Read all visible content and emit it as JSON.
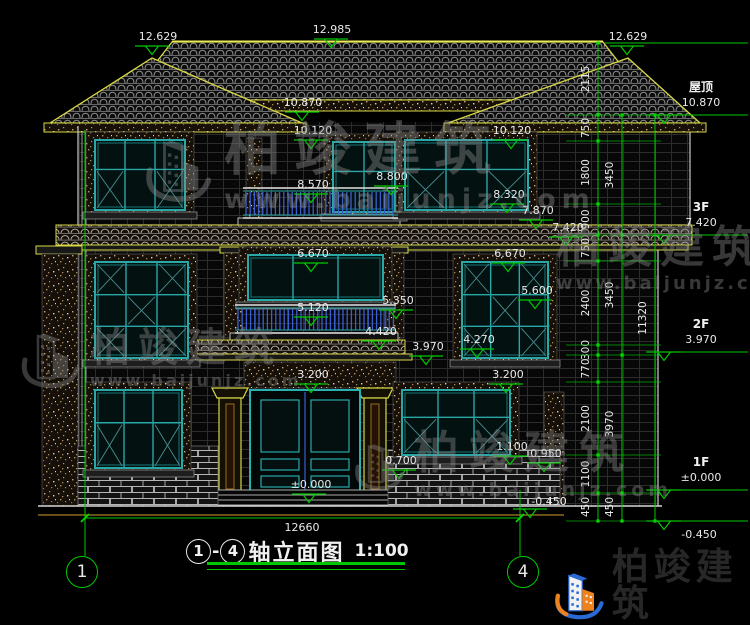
{
  "brand": {
    "name": "柏竣建筑",
    "site": "www.baijunjz.com"
  },
  "title": {
    "axis_start": "1",
    "dash": "-",
    "axis_end": "4",
    "text": "轴立面图",
    "scale": "1:100"
  },
  "axis_bubbles": [
    "1",
    "4"
  ],
  "width_dim": "12660",
  "elevation_labels": [
    "12.629",
    "12.985",
    "12.629",
    "10.870",
    "10.120",
    "10.120",
    "8.570",
    "8.800",
    "8.320",
    "7.870",
    "7.420",
    "6.670",
    "6.670",
    "5.600",
    "5.350",
    "5.120",
    "4.420",
    "4.270",
    "3.970",
    "3.200",
    "3.200",
    "1.100",
    "0.950",
    "0.700",
    "±0.000",
    "-0.450"
  ],
  "right_levels": [
    {
      "name": "屋顶",
      "value": "10.870"
    },
    {
      "name": "3F",
      "value": "7.420"
    },
    {
      "name": "2F",
      "value": "3.970"
    },
    {
      "name": "1F",
      "value": "±0.000"
    },
    {
      "name": "",
      "value": "-0.450"
    }
  ],
  "right_dim_chains": {
    "inner": [
      "2115",
      "750",
      "1800",
      "900",
      "750",
      "2400",
      "300",
      "770",
      "2100",
      "1100",
      "450"
    ],
    "middle": [
      "3450",
      "3450",
      "3970",
      "450"
    ],
    "outer": [
      "11320"
    ]
  },
  "colors": {
    "dim_green": "#00c800",
    "window_teal": "#2aa8a8",
    "trim_yellow": "#d8d845",
    "railing_blue": "#3a5fd0",
    "logo_blue": "#2a6ad4",
    "logo_orange": "#f0821e",
    "background": "#000000"
  }
}
